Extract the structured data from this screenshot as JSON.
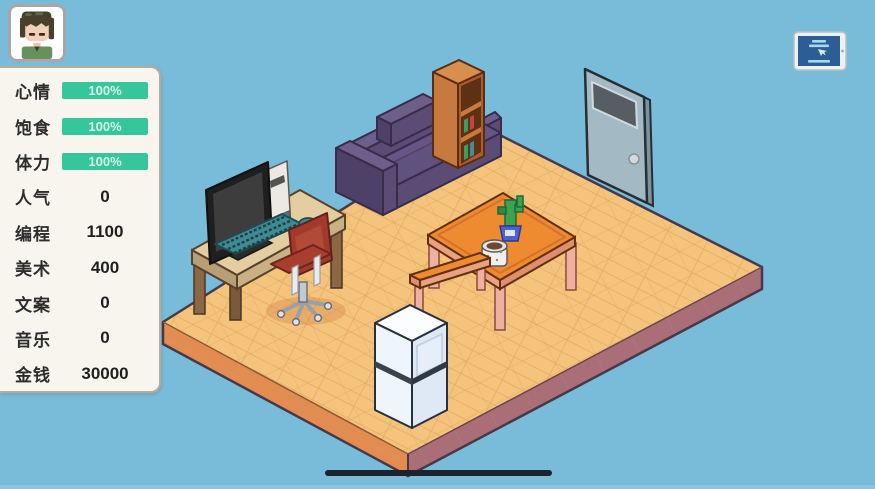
{
  "hud": {
    "avatar_button": {
      "icon": "player-avatar-icon"
    },
    "stats": [
      {
        "label": "心情",
        "type": "bar",
        "value": "100%",
        "percent": 100
      },
      {
        "label": "饱食",
        "type": "bar",
        "value": "100%",
        "percent": 100
      },
      {
        "label": "体力",
        "type": "bar",
        "value": "100%",
        "percent": 100
      },
      {
        "label": "人气",
        "type": "number",
        "value": "0"
      },
      {
        "label": "编程",
        "type": "number",
        "value": "1100"
      },
      {
        "label": "美术",
        "type": "number",
        "value": "400"
      },
      {
        "label": "文案",
        "type": "number",
        "value": "0"
      },
      {
        "label": "音乐",
        "type": "number",
        "value": "0"
      },
      {
        "label": "金钱",
        "type": "number",
        "value": "30000"
      }
    ],
    "tablet_button": {
      "icon": "tablet-icon"
    }
  },
  "room": {
    "objects": [
      "sofa",
      "bookshelf",
      "door",
      "computer-desk",
      "monitor",
      "pc-tower",
      "keyboard",
      "mouse",
      "office-chair",
      "dining-table",
      "cactus-plant",
      "coffee-mug",
      "bench",
      "refrigerator"
    ]
  },
  "colors": {
    "background": "#79bcd9",
    "stat_bar_green": "#35c79b",
    "panel_bg": "#f8f5ef",
    "floor_top": "#f4c47c",
    "floor_side_left": "#e28c52",
    "floor_side_right": "#a96e77",
    "sofa_purple": "#5b4c75",
    "table_orange": "#ee8a30",
    "home_indicator": "#1b2230"
  }
}
